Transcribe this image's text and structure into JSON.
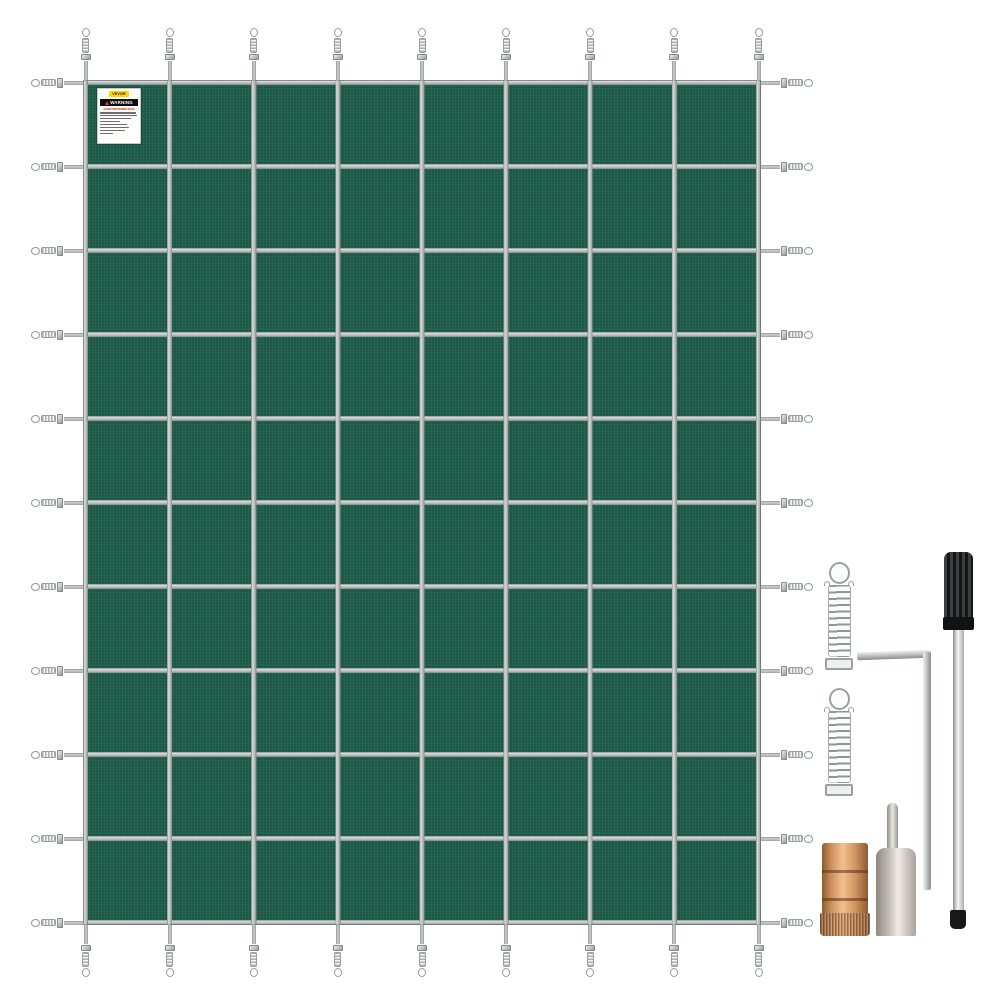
{
  "page": {
    "background_color": "#ffffff",
    "description": "Product photo of a green rectangular mesh pool safety cover with stainless strap grid and installation hardware"
  },
  "product": {
    "cover": {
      "mesh_color": "#1e5c4b",
      "strap_color": "#b2b8b5",
      "grid_columns": 8,
      "grid_rows": 10,
      "vertical_straps": 9,
      "horizontal_straps": 11
    },
    "label": {
      "brand": "VEVOR",
      "brand_bg": "#ffd500",
      "warning_title": "WARNING",
      "warning_subtitle": "AVOID DROWNING RISK",
      "warning_bar_color": "#0d0d0d",
      "warning_text_color": "#ffffff",
      "subtitle_color": "#c31d1d",
      "fine_print_lines": 8
    },
    "accessories": [
      {
        "name": "stainless-spring",
        "count_shown": 2,
        "color": "#c9cecc"
      },
      {
        "name": "hex-key",
        "color": "#bcc2c0"
      },
      {
        "name": "installation-rod",
        "handle_color": "#1a1c1e",
        "shaft_color": "#d9dedc"
      },
      {
        "name": "brass-anchor",
        "color": "#d09561"
      },
      {
        "name": "anchor-with-pin",
        "color": "#cfc8c2"
      }
    ]
  }
}
